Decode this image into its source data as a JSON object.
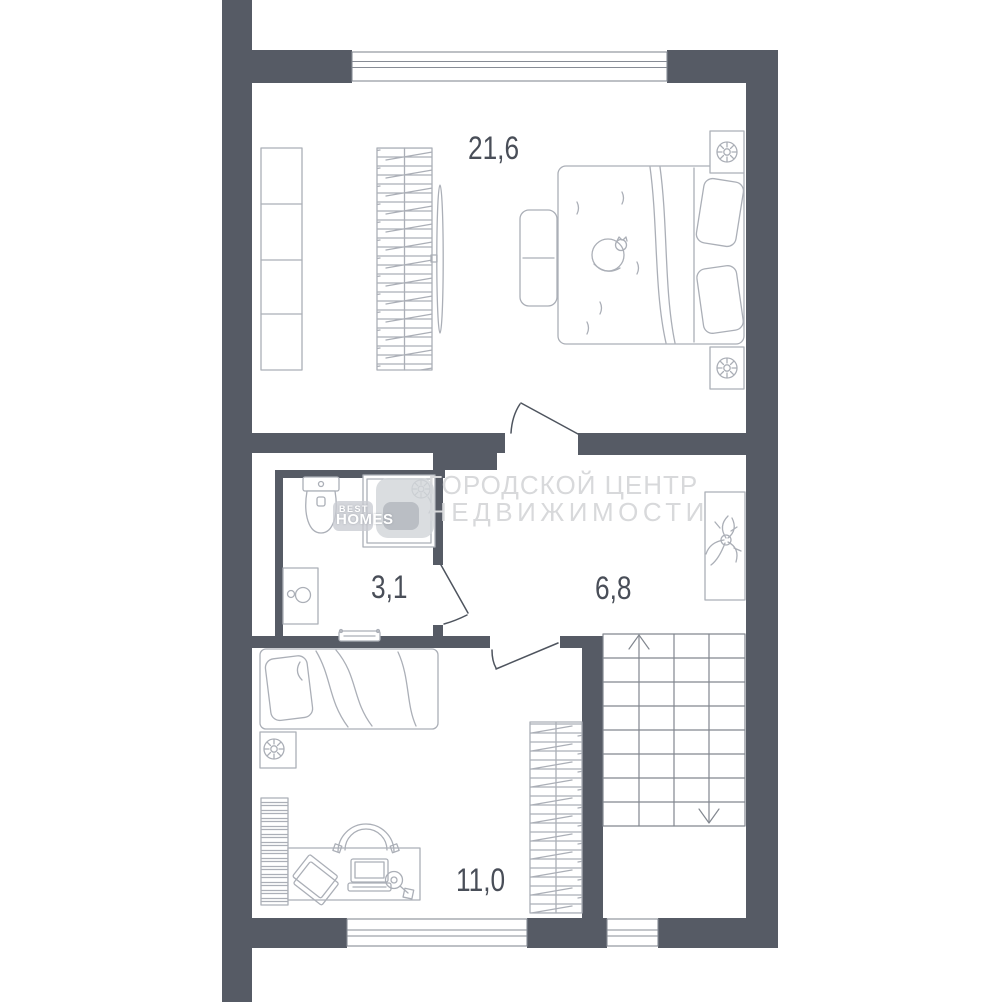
{
  "title": "Floor plan",
  "colors": {
    "wall": "#565B65",
    "furniture_line": "#ABAFB7",
    "door_line": "#4E545E",
    "stair_line": "#82878F",
    "window_line": "#878C95",
    "label": "#494E58",
    "watermark_text": "#D8D9DB",
    "logo_text": "#FFFFFF",
    "background": "#FFFFFF"
  },
  "rooms": [
    {
      "id": "bedroom",
      "area": "21,6"
    },
    {
      "id": "bathroom",
      "area": "3,1"
    },
    {
      "id": "hallway",
      "area": "6,8"
    },
    {
      "id": "bedroom2",
      "area": "11,0"
    }
  ],
  "watermark": {
    "line1": "ГОРОДСКОЙ ЦЕНТР",
    "line2": "НЕДВИЖИМОСТИ",
    "logo_top": "BEST",
    "logo_bottom": "HOMES"
  }
}
